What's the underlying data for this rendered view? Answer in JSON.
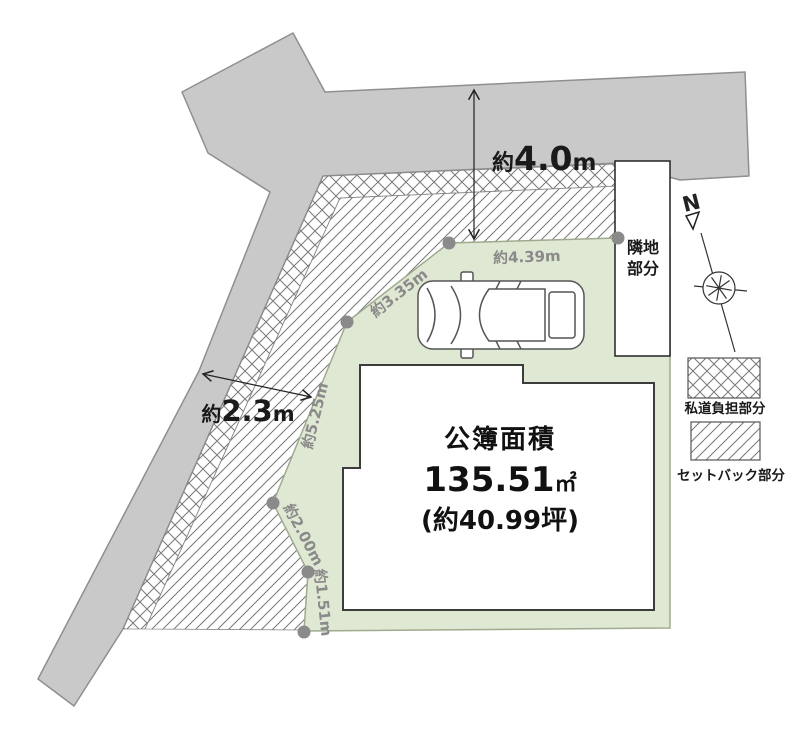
{
  "area_box": {
    "title": "公簿面積",
    "value": "135.51",
    "unit": "㎡",
    "tsubo": "(約40.99坪)"
  },
  "dimensions": {
    "top_road": {
      "prefix": "約",
      "value": "4.0",
      "unit": "m"
    },
    "left_road": {
      "prefix": "約",
      "value": "2.3",
      "unit": "m"
    }
  },
  "boundaries": {
    "top": "約4.39m",
    "upper_left": "約3.35m",
    "left": "約5.25m",
    "lower_left": "約2.00m",
    "bottom_left": "約1.51m"
  },
  "neighbor": {
    "line1": "隣地",
    "line2": "部分"
  },
  "compass": {
    "north": "N"
  },
  "legend": {
    "private_road": "私道負担部分",
    "setback": "セットバック部分"
  },
  "colors": {
    "plot": "#dfe8d3",
    "road": "#c9c9c9",
    "marker": "#8a8a8a",
    "hatch": "#787878"
  }
}
